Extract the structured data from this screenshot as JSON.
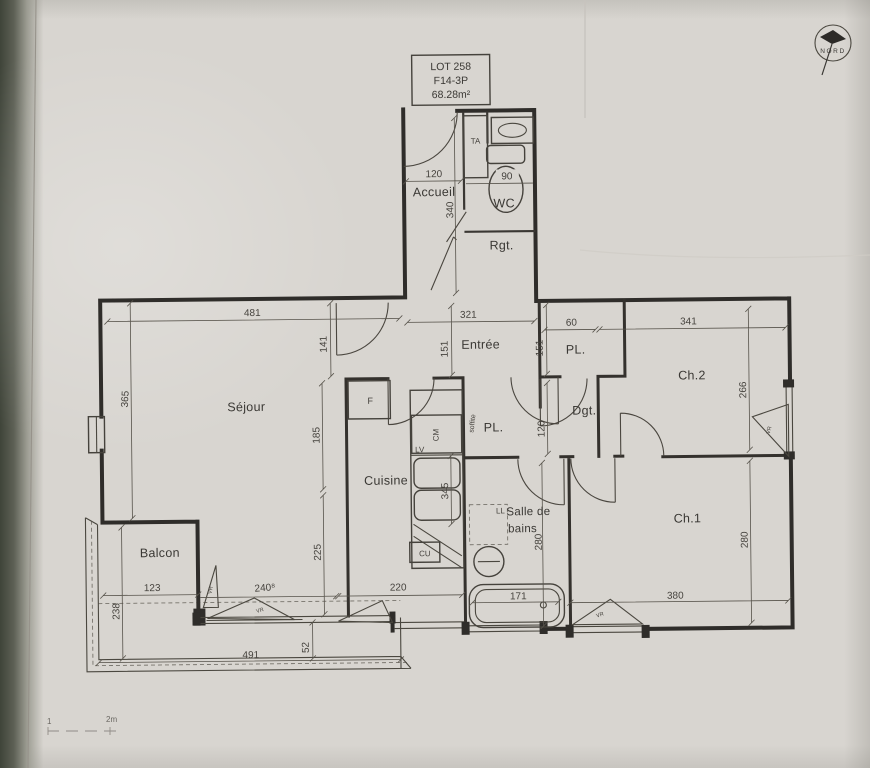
{
  "colors": {
    "paper": "#d8d5d0",
    "ink": "#3a3834",
    "backdrop": "#3f4439"
  },
  "title_block": {
    "lot": "LOT 258",
    "type": "F14-3P",
    "area": "68.28m²"
  },
  "north": {
    "label": "NORD"
  },
  "rooms": {
    "accueil": "Accueil",
    "wc": "WC",
    "rgt": "Rgt.",
    "entree": "Entrée",
    "pl_hall": "PL.",
    "pl_kitchen": "PL.",
    "dgt": "Dgt.",
    "sejour": "Séjour",
    "cuisine": "Cuisine",
    "sdb_line1": "Salle de",
    "sdb_line2": "bains",
    "ch1": "Ch.1",
    "ch2": "Ch.2",
    "balcon": "Balcon"
  },
  "equipment": {
    "ta": "TA",
    "fridge": "F",
    "lv": "LV",
    "cm": "CM",
    "cu": "CU",
    "ll": "LL",
    "soffite": "soffite",
    "vr": "VR"
  },
  "dims": {
    "d120_entry": "120",
    "d90": "90",
    "d340": "340",
    "d481": "481",
    "d141": "141",
    "d321": "321",
    "d151a": "151",
    "d151b": "151",
    "d60": "60",
    "d341": "341",
    "d365": "365",
    "d266": "266",
    "d185": "185",
    "d120_dgt": "120",
    "d225": "225",
    "d345": "345",
    "d280_sdb": "280",
    "d280_ch1": "280",
    "d123": "123",
    "d240": "240⁸",
    "d220": "220",
    "d171": "171",
    "d380": "380",
    "d238": "238",
    "d491": "491",
    "d52": "52"
  },
  "scale": {
    "one": "1",
    "two": "2m"
  }
}
